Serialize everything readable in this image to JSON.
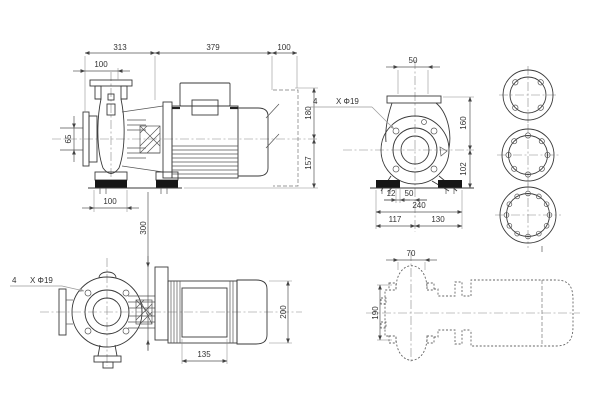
{
  "page": {
    "background": "#ffffff",
    "line_color": "#3a3a3a"
  },
  "views": {
    "side": {
      "title": "side-elevation-view",
      "dims": {
        "a313": "313",
        "a379": "379",
        "a100end": "100",
        "a100flange": "100",
        "a65": "65",
        "a100base": "100",
        "a180": "180",
        "a157": "157"
      }
    },
    "front": {
      "title": "front-elevation-view",
      "holes_qty": "4",
      "holes_label": "X Φ19",
      "dims": {
        "f50": "50",
        "f160": "160",
        "f102": "102",
        "f12": "12",
        "f50b": "50",
        "f240": "240",
        "f117": "117",
        "f130": "130"
      }
    },
    "plan": {
      "title": "plan-view",
      "holes_qty": "4",
      "holes_label": "X Φ19",
      "dims": {
        "p300": "300",
        "p135": "135",
        "p200": "200"
      }
    },
    "outline": {
      "title": "phantom-outline-view",
      "dims": {
        "o70": "70",
        "o190": "190"
      }
    },
    "flanges": {
      "title": "flange-detail-views",
      "count": 3
    }
  }
}
